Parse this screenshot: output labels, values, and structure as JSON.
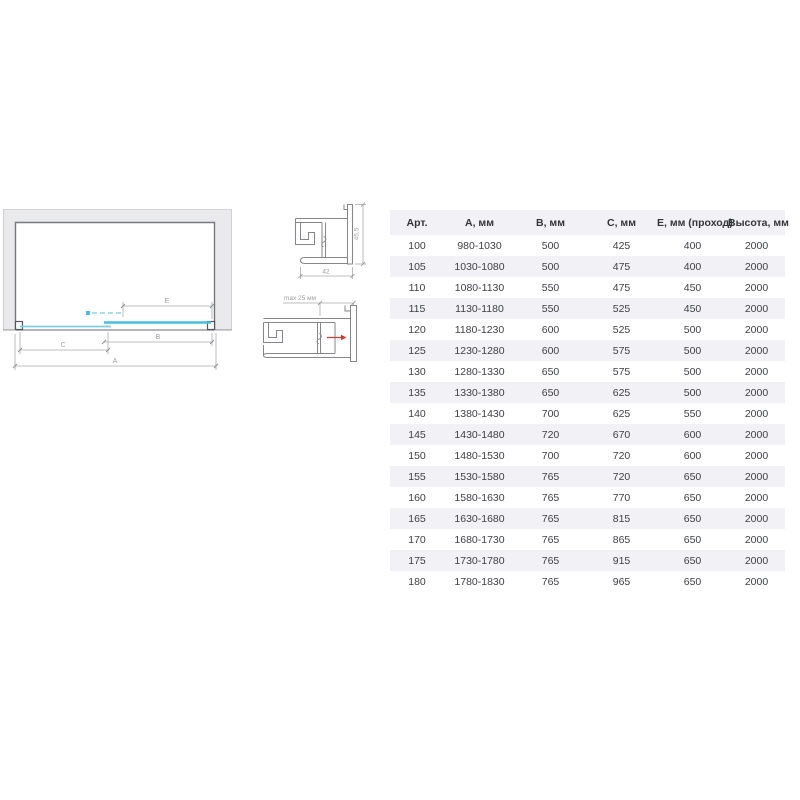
{
  "diagram": {
    "dimension_labels": {
      "a": "A",
      "b": "B",
      "c": "C",
      "e": "E"
    },
    "profile_top": {
      "height_label": "45,5",
      "width_label": "42"
    },
    "profile_bottom": {
      "max_label": "max 25 мм"
    },
    "colors": {
      "glass_door": "#49bddf",
      "glass_fixed": "#7fcde6",
      "glass_dash": "#a5dff0",
      "red_arrow": "#d23b2e",
      "wall_fill": "#eaeaed",
      "wall_edge": "#77787d",
      "dim_line": "#a9aaae",
      "dim_text": "#9b9ca2"
    }
  },
  "table": {
    "header_bg": "#f1f1f6",
    "stripe_color": "#f1f1f6",
    "columns": [
      "Арт.",
      "А, мм",
      "В, мм",
      "С, мм",
      "Е, мм (проход)",
      "Высота, мм"
    ],
    "rows": [
      [
        "100",
        "980-1030",
        "500",
        "425",
        "400",
        "2000"
      ],
      [
        "105",
        "1030-1080",
        "500",
        "475",
        "400",
        "2000"
      ],
      [
        "110",
        "1080-1130",
        "550",
        "475",
        "450",
        "2000"
      ],
      [
        "115",
        "1130-1180",
        "550",
        "525",
        "450",
        "2000"
      ],
      [
        "120",
        "1180-1230",
        "600",
        "525",
        "500",
        "2000"
      ],
      [
        "125",
        "1230-1280",
        "600",
        "575",
        "500",
        "2000"
      ],
      [
        "130",
        "1280-1330",
        "650",
        "575",
        "500",
        "2000"
      ],
      [
        "135",
        "1330-1380",
        "650",
        "625",
        "500",
        "2000"
      ],
      [
        "140",
        "1380-1430",
        "700",
        "625",
        "550",
        "2000"
      ],
      [
        "145",
        "1430-1480",
        "720",
        "670",
        "600",
        "2000"
      ],
      [
        "150",
        "1480-1530",
        "700",
        "720",
        "600",
        "2000"
      ],
      [
        "155",
        "1530-1580",
        "765",
        "720",
        "650",
        "2000"
      ],
      [
        "160",
        "1580-1630",
        "765",
        "770",
        "650",
        "2000"
      ],
      [
        "165",
        "1630-1680",
        "765",
        "815",
        "650",
        "2000"
      ],
      [
        "170",
        "1680-1730",
        "765",
        "865",
        "650",
        "2000"
      ],
      [
        "175",
        "1730-1780",
        "765",
        "915",
        "650",
        "2000"
      ],
      [
        "180",
        "1780-1830",
        "765",
        "965",
        "650",
        "2000"
      ]
    ]
  }
}
